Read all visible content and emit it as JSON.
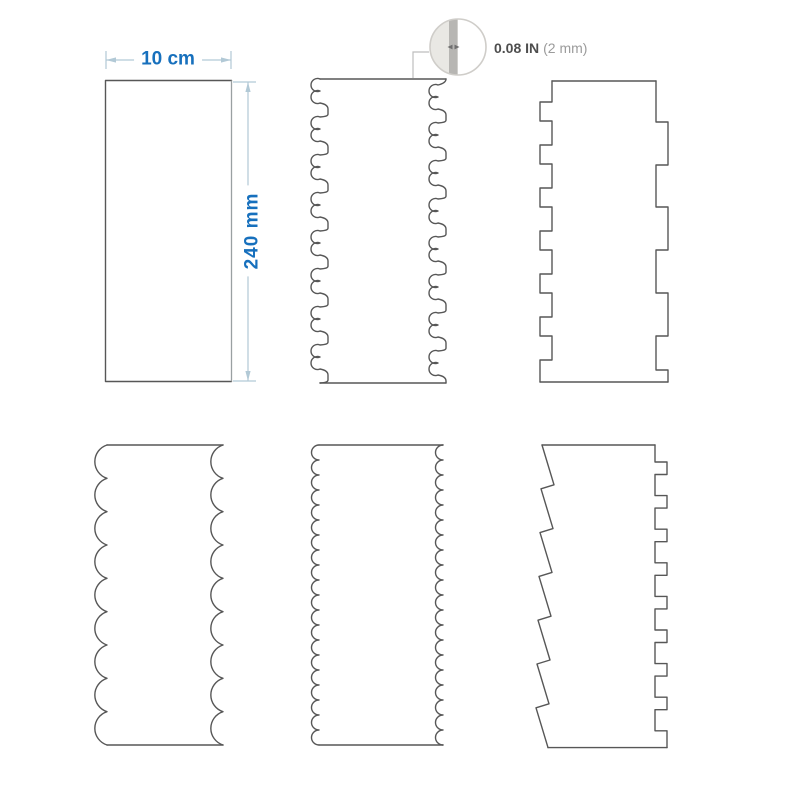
{
  "dimensions": {
    "width_label": "10 cm",
    "height_label": "240 mm",
    "thickness_primary": "0.08 IN",
    "thickness_secondary": "(2 mm)"
  },
  "colors": {
    "dimension_text_blue": "#1770bd",
    "dimension_line": "#b2c9d6",
    "outline_gray": "#575757",
    "outline_light_gray": "#9aa0a2",
    "thickness_text": "#4e4e4e",
    "thickness_text_light": "#9b9b9b",
    "callout_half_fill": "#e9e8e4",
    "callout_band_fill": "#b7b6b3"
  }
}
